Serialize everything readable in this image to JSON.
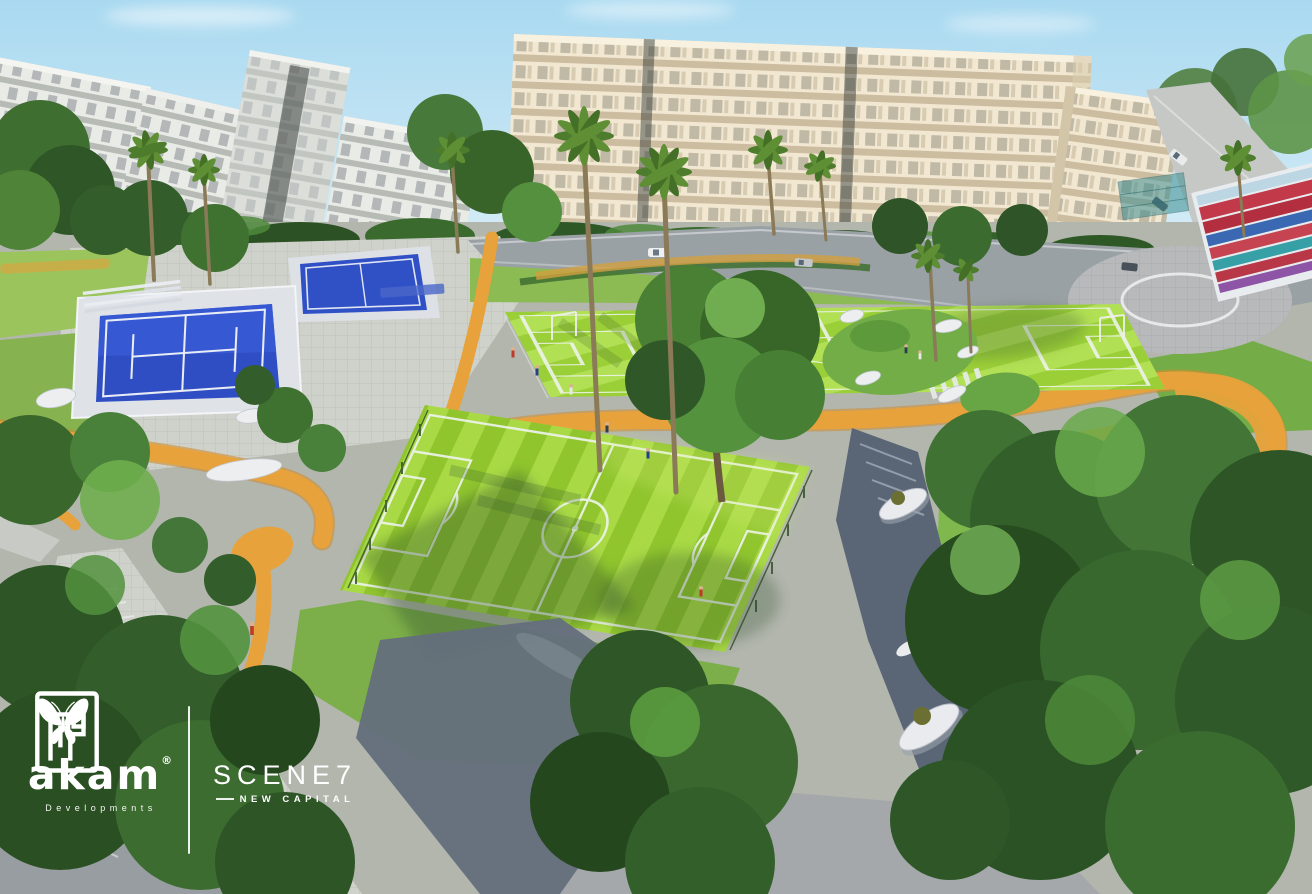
{
  "branding": {
    "developer": {
      "name": "akam",
      "registered_mark": "®",
      "subtitle": "Developments"
    },
    "project": {
      "title": "SCENE",
      "number": "7",
      "subtitle": "NEW CAPITAL"
    }
  },
  "scene": {
    "features": [
      "apartment-buildings",
      "football-field-main",
      "football-field-upper",
      "padel-courts",
      "jogging-track",
      "palm-trees",
      "tree-clusters",
      "roundabout",
      "grandstand-seating",
      "sculptural-benches",
      "promenade",
      "pedestrians",
      "cars"
    ]
  },
  "palette": {
    "sky": "#aedcf2",
    "building_cream": "#f2e8d2",
    "building_white": "#e9ebe6",
    "grass_bright": "#a8da44",
    "grass_dark": "#93c731",
    "court_blue": "#2f4ec4",
    "track_orange": "#e7a23b",
    "road_gray": "#9aa1a5",
    "promenade_slate": "#5a6676",
    "foliage_dark": "#2c5124",
    "foliage_light": "#6fae4e",
    "marking_white": "#edf3ea",
    "stand_red": "#c23a4a",
    "stand_blue": "#3a68b2",
    "stand_teal": "#37a0a6",
    "logo_white": "#ffffff"
  }
}
